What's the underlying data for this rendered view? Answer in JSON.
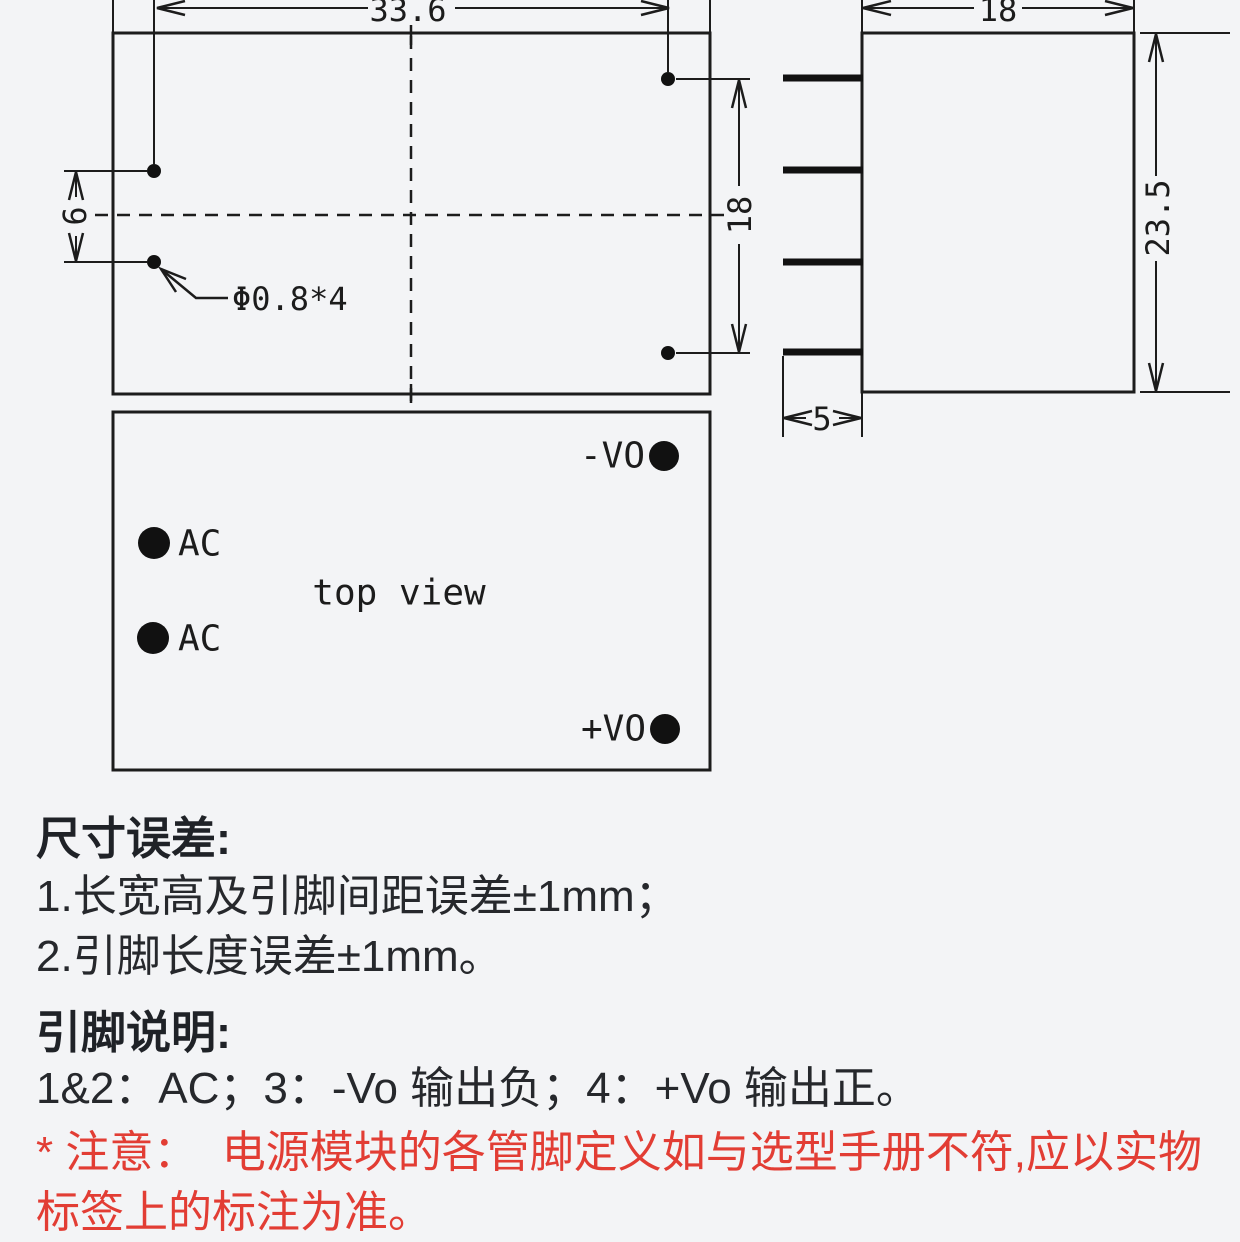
{
  "meta": {
    "drawing_type": "power module dimension drawing",
    "line_color": "#1c1c1c",
    "warn_color": "#e23d34",
    "background": "#f3f4f6"
  },
  "bottom_view": {
    "dim_pin_row_spacing": "33.6",
    "dim_ac_pin_gap": "6",
    "dim_out_pin_gap": "18",
    "hole_label": "Φ0.8*4"
  },
  "side_view": {
    "dim_width": "18",
    "dim_height": "23.5",
    "dim_pin_length": "5"
  },
  "top_view": {
    "title": "top view",
    "pin_neg_out": "-VO",
    "pin_ac_upper": "AC",
    "pin_ac_lower": "AC",
    "pin_pos_out": "+VO"
  },
  "notes": {
    "size_heading": "尺寸误差:",
    "size_line1": "1.长宽高及引脚间距误差±1mm；",
    "size_line2": "2.引脚长度误差±1mm。",
    "pin_heading": "引脚说明:",
    "pin_line": "1&2：AC；3：-Vo 输出负；4：+Vo 输出正。",
    "warn_line1": "* 注意：  电源模块的各管脚定义如与选型手册不符,应以实物",
    "warn_line2": "标签上的标注为准。"
  }
}
